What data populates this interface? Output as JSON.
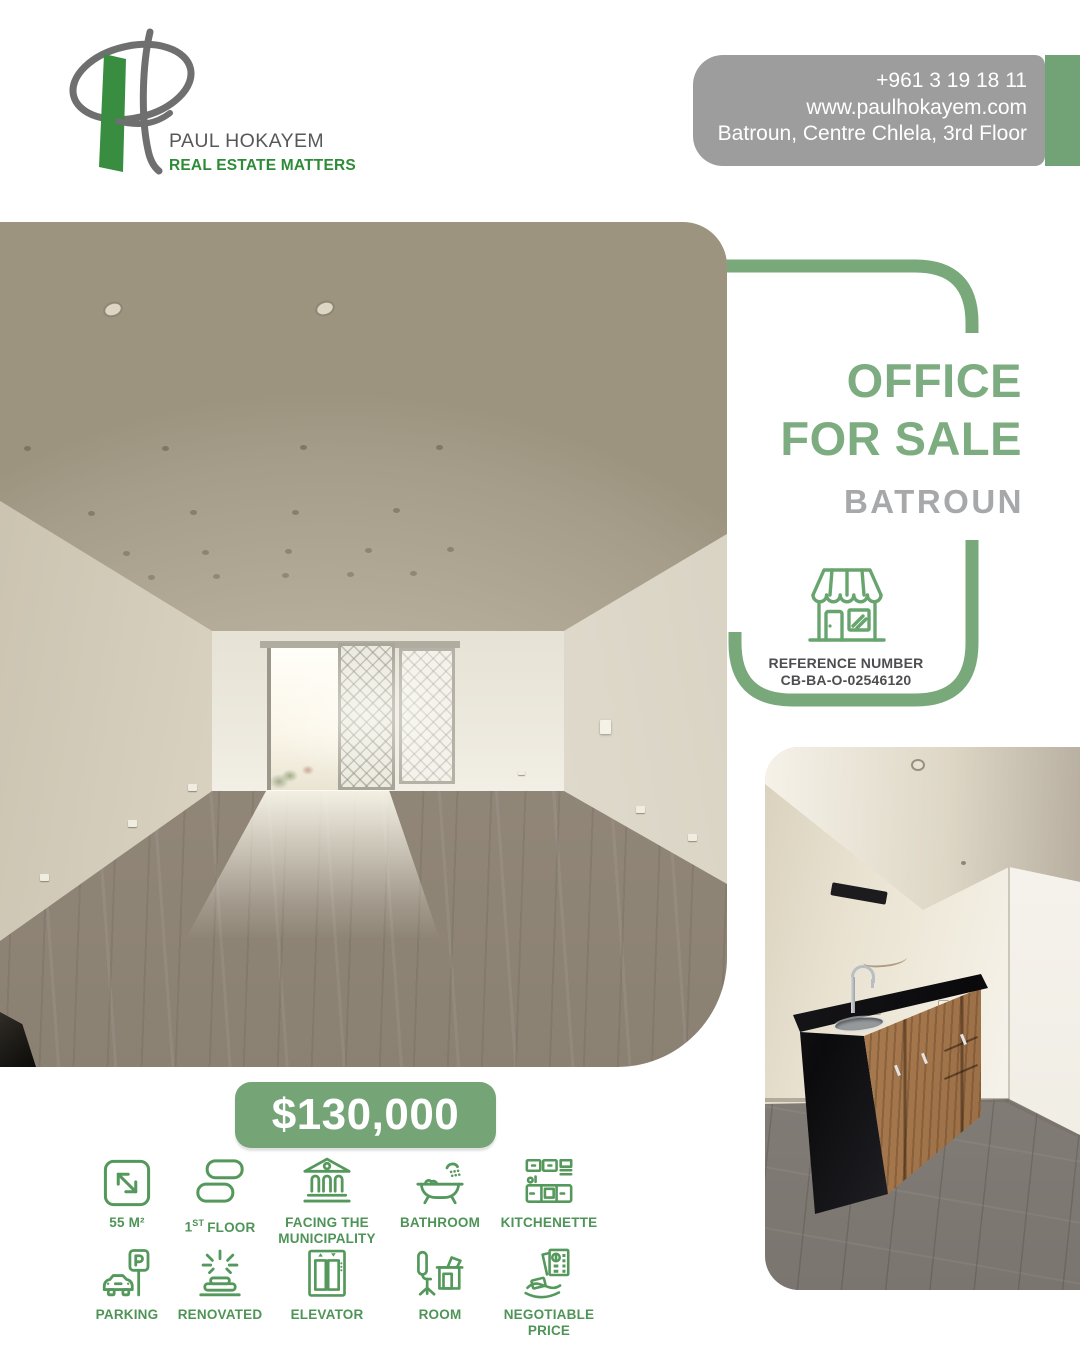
{
  "brand": {
    "name": "PAUL HOKAYEM",
    "tagline": "REAL ESTATE MATTERS"
  },
  "contact": {
    "phone": "+961 3 19 18 11",
    "website": "www.paulhokayem.com",
    "address": "Batroun, Centre Chlela, 3rd Floor"
  },
  "listing": {
    "title_line1": "OFFICE",
    "title_line2": "FOR SALE",
    "location": "BATROUN",
    "reference_label": "REFERENCE NUMBER",
    "reference_number": "CB-BA-O-02546120",
    "price": "$130,000"
  },
  "photos": {
    "main": "Empty renovated office interior with wooden floor, spotlight ceiling and lattice glass door",
    "secondary": "Kitchenette corner with black countertop, steel sink, wooden cabinets and gray tile floor"
  },
  "features": {
    "row1": [
      {
        "id": "area",
        "label": "55 M²"
      },
      {
        "id": "floor",
        "num": "1",
        "sup": "ST",
        "rest": "FLOOR"
      },
      {
        "id": "municipality",
        "line1": "FACING THE",
        "line2": "MUNICIPALITY"
      },
      {
        "id": "bathroom",
        "label": "BATHROOM"
      },
      {
        "id": "kitchenette",
        "label": "KITCHENETTE"
      }
    ],
    "row2": [
      {
        "id": "parking",
        "label": "PARKING"
      },
      {
        "id": "renovated",
        "label": "RENOVATED"
      },
      {
        "id": "elevator",
        "label": "ELEVATOR"
      },
      {
        "id": "room",
        "label": "ROOM"
      },
      {
        "id": "negotiable",
        "line1": "NEGOTIABLE",
        "line2": "PRICE"
      }
    ]
  },
  "colors": {
    "sage": "#79a87b",
    "heading_green": "#7dac80",
    "icon_green": "#55985c",
    "label_green": "#4e9457",
    "logo_green": "#388d40",
    "tagline_green": "#2e8b38",
    "contact_gray": "#9c9d9c",
    "strip_green": "#72a376",
    "location_gray": "#a7a8aa",
    "reference_text": "#4d4e50",
    "price_bg": "#75a577"
  }
}
